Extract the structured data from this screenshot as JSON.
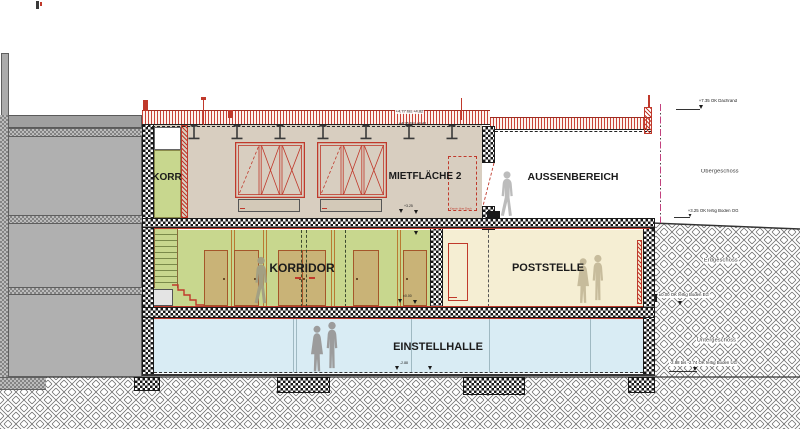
{
  "rooms": {
    "korr": {
      "label": "KORR",
      "color": "#c8d78e"
    },
    "mietflaeche2": {
      "label": "MIETFLÄCHE 2",
      "color": "#d8cec0"
    },
    "aussenbereich": {
      "label": "AUSSENBEREICH",
      "color": "#ffffff"
    },
    "korridor": {
      "label": "KORRIDOR",
      "color": "#c8d78e"
    },
    "poststelle": {
      "label": "POSTSTELLE",
      "color": "#f5eed3"
    },
    "einstellhalle": {
      "label": "EINSTELLHALLE",
      "color": "#d9ecf4"
    }
  },
  "levels": {
    "og": "Obergeschoss",
    "eg": "Erdgeschoss",
    "ug": "Untergeschoss"
  },
  "elevations": {
    "dachrand": "+7.35 OK Dachrand",
    "roof_upper": "+4.77 bis +4.82",
    "roof_lower": "+4.36 bis +4.41",
    "boden_og": "+3.25 OK fertig Boden OG",
    "boden_eg": "±0.00 OK fertig Boden EG",
    "boden_ug": "-2.88 bis -2.74 OK fertig Boden UG",
    "og_floor_mark": "+3.25",
    "eg_floor_mark": "±0.00",
    "ug_floor_mark": "-2.88"
  },
  "notes": {
    "shaft": "Kamin über Dach"
  },
  "colors": {
    "accent_red": "#c0392b",
    "neighbor_gray": "#b0b0b0",
    "door_tan": "#c9b377",
    "door_frame": "#a5562a",
    "ground_line": "#333333"
  }
}
